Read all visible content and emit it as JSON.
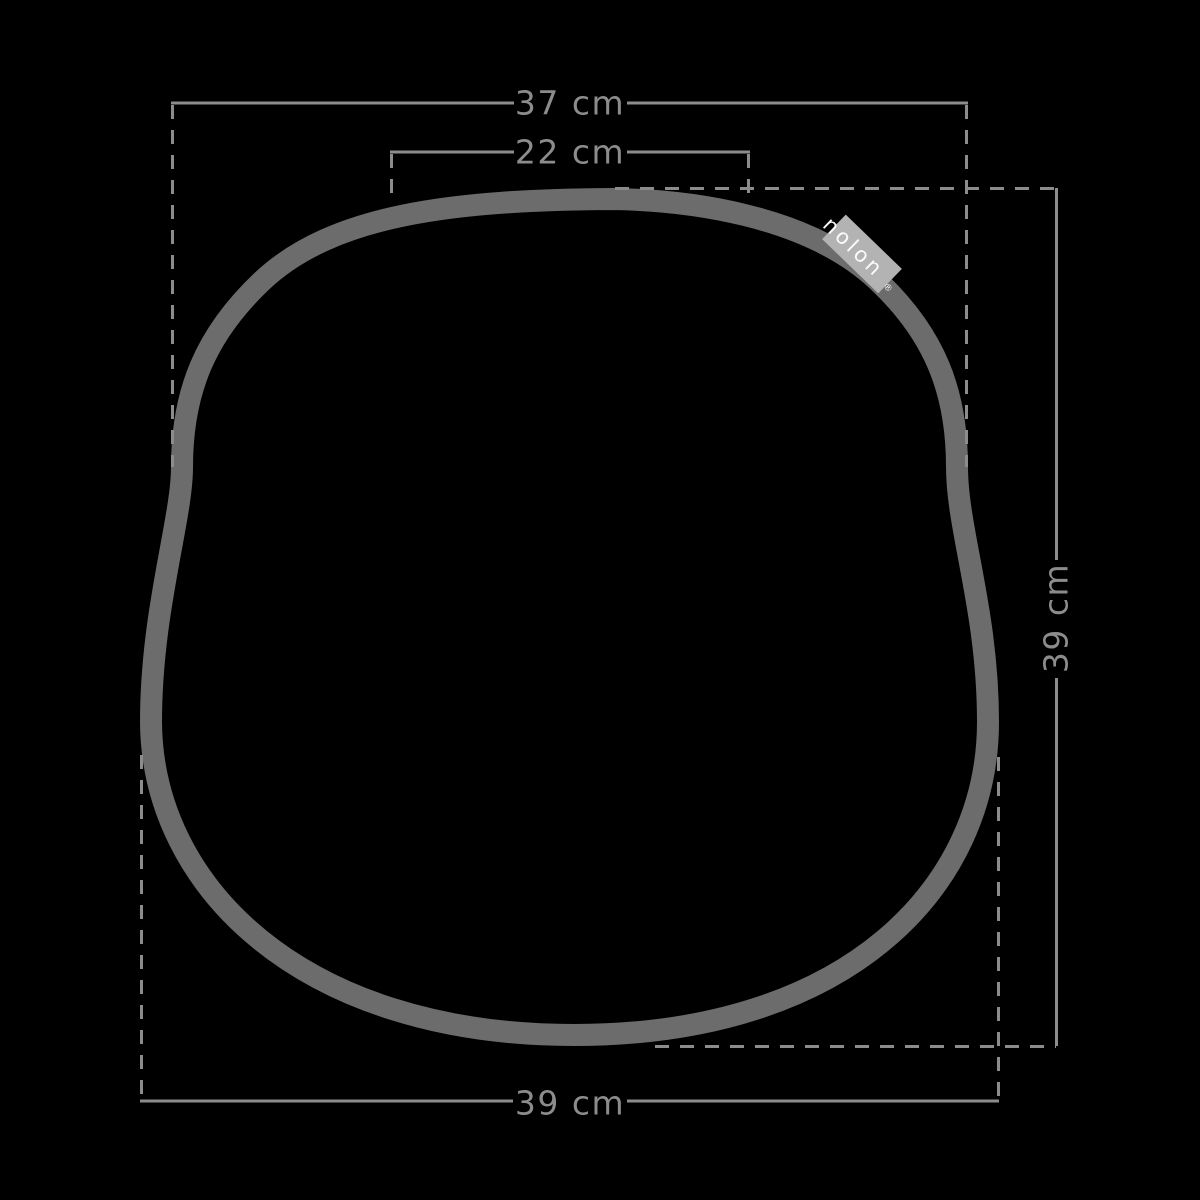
{
  "diagram": {
    "description": "Top view dimension drawing of a seat cushion outline",
    "background_color": "#000000",
    "outline_color": "#6c6c6c",
    "dimension_color": "#8c8c8c",
    "dimensions": {
      "top_width": "37 cm",
      "inner_width": "22 cm",
      "side_height": "39 cm",
      "bottom_width": "39 cm"
    },
    "brand_tag": {
      "label": "nolon",
      "registered_mark": "®",
      "bg_color": "#b3b3b3",
      "text_color": "#fafafa"
    }
  }
}
